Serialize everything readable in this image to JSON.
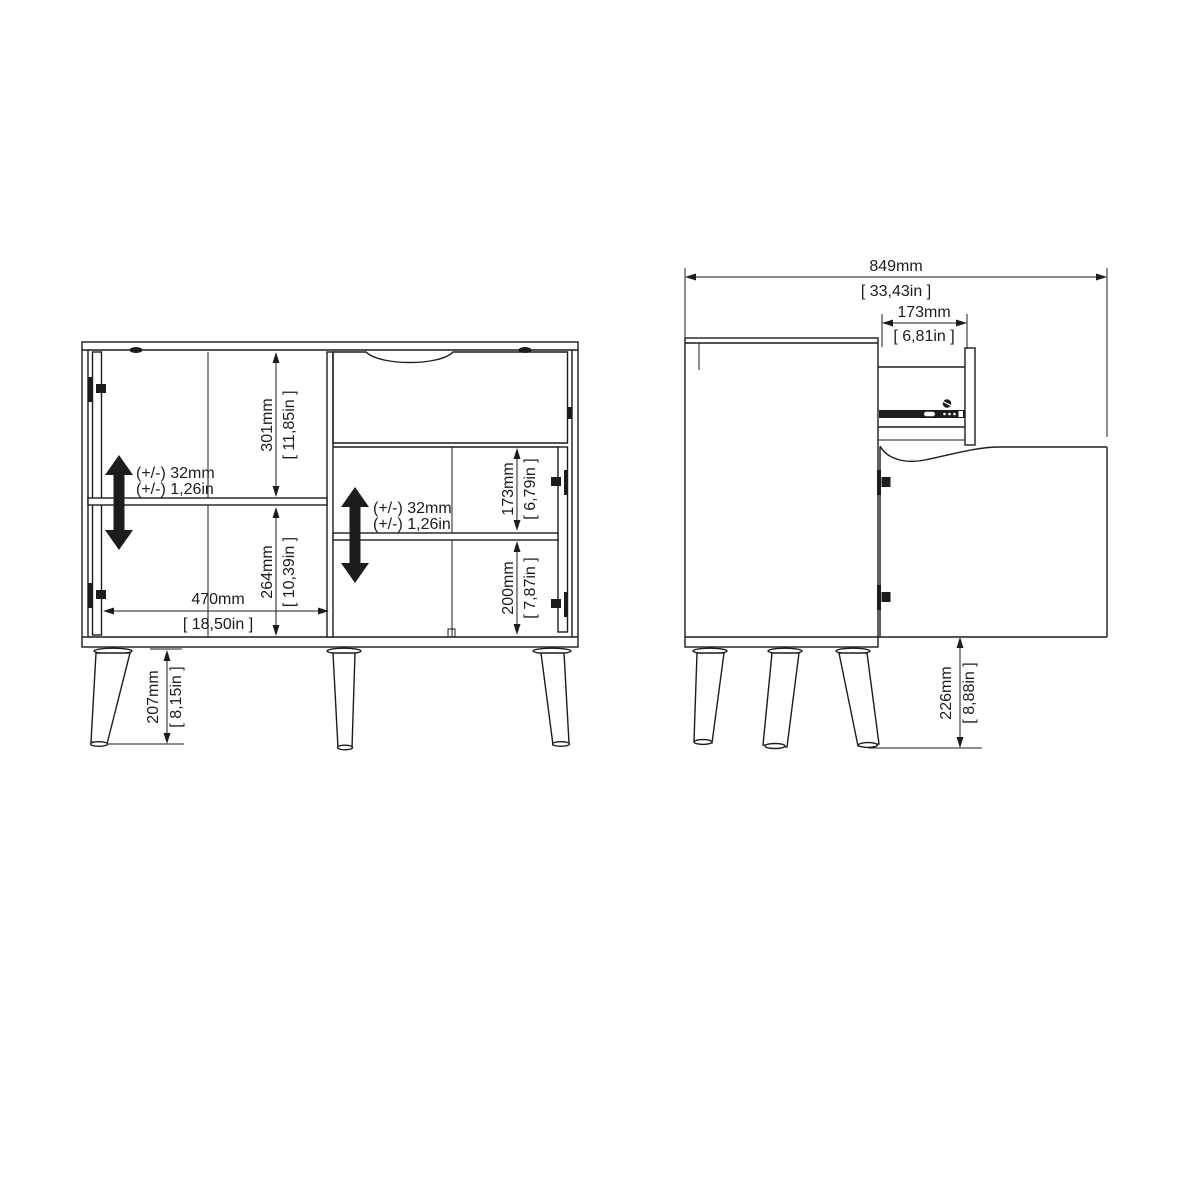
{
  "drawing": {
    "background_color": "#ffffff",
    "line_color": "#1c1c1c",
    "front_view": {
      "upper_section_height": {
        "mm": "301mm",
        "inch": "[ 11,85in ]"
      },
      "lower_section_height": {
        "mm": "264mm",
        "inch": "[ 10,39in ]"
      },
      "left_inner_width": {
        "mm": "470mm",
        "inch": "[ 18,50in ]"
      },
      "leg_height": {
        "mm": "207mm",
        "inch": "[ 8,15in ]"
      },
      "right_upper_height": {
        "mm": "173mm",
        "inch": "[ 6,79in ]"
      },
      "right_lower_height": {
        "mm": "200mm",
        "inch": "[ 7,87in ]"
      },
      "shelf_adjust_tolerance": {
        "mm": "(+/-) 32mm",
        "inch": "(+/-) 1,26in"
      }
    },
    "side_view": {
      "total_depth": {
        "mm": "849mm",
        "inch": "[ 33,43in ]"
      },
      "drawer_extension": {
        "mm": "173mm",
        "inch": "[ 6,81in ]"
      },
      "leg_height": {
        "mm": "226mm",
        "inch": "[ 8,88in ]"
      }
    },
    "icons": {
      "adjustable_shelf": "double-vertical-arrow-icon"
    }
  }
}
